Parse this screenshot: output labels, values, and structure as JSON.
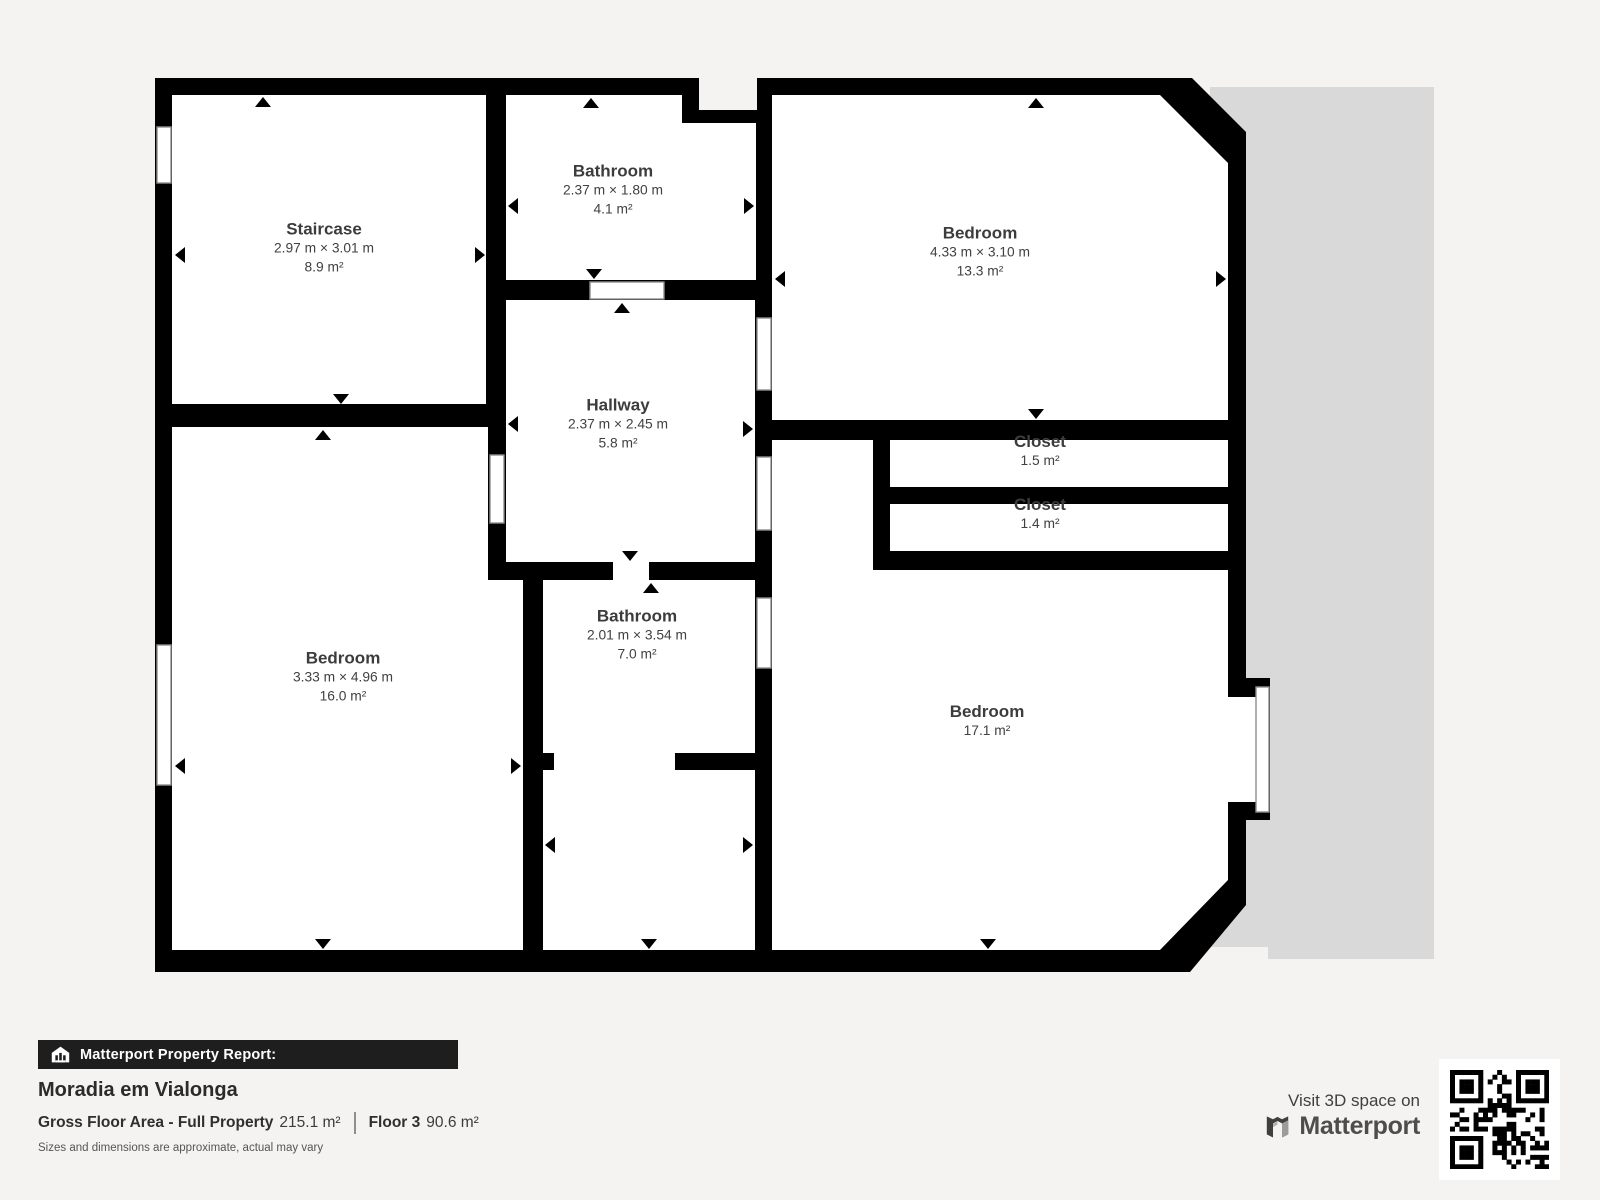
{
  "plan": {
    "wall_color": "#000000",
    "floor_color": "#ffffff",
    "outside_area_color": "#d9d9d9",
    "rooms": [
      {
        "name": "Staircase",
        "dims": "2.97 m × 3.01 m",
        "area": "8.9 m²"
      },
      {
        "name": "Bathroom",
        "dims": "2.37 m × 1.80 m",
        "area": "4.1 m²"
      },
      {
        "name": "Bedroom",
        "dims": "4.33 m × 3.10 m",
        "area": "13.3 m²"
      },
      {
        "name": "Hallway",
        "dims": "2.37 m × 2.45 m",
        "area": "5.8 m²"
      },
      {
        "name": "Closet",
        "area": "1.5 m²"
      },
      {
        "name": "Closet",
        "area": "1.4 m²"
      },
      {
        "name": "Bedroom",
        "dims": "3.33 m × 4.96 m",
        "area": "16.0 m²"
      },
      {
        "name": "Bathroom",
        "dims": "2.01 m × 3.54 m",
        "area": "7.0 m²"
      },
      {
        "name": "Bedroom",
        "area": "17.1 m²"
      }
    ]
  },
  "footer": {
    "report_label": "Matterport Property Report:",
    "property_name": "Moradia em Vialonga",
    "gross_label": "Gross Floor Area - Full Property",
    "gross_value": "215.1 m²",
    "floor_label": "Floor 3",
    "floor_value": "90.6 m²",
    "disclaimer": "Sizes and dimensions are approximate, actual may vary"
  },
  "branding": {
    "visit_text": "Visit 3D space on",
    "brand_name": "Matterport",
    "qr_label": "qr-code"
  }
}
